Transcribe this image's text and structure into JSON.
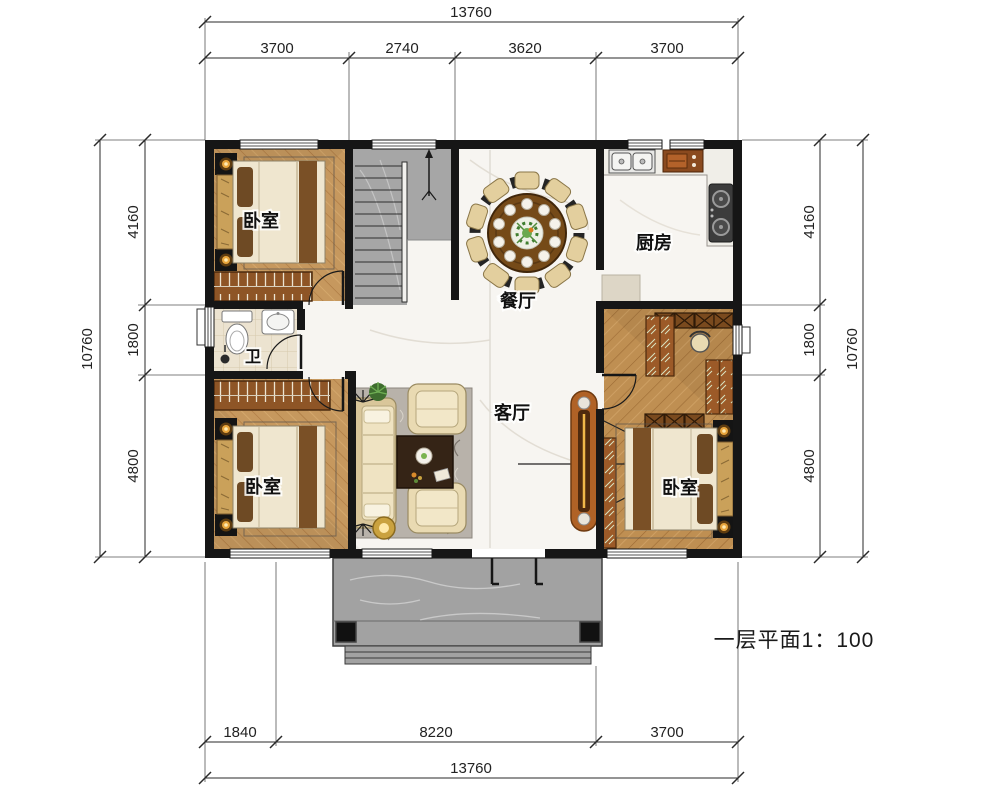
{
  "title": "一层平面1：100",
  "dimensions": {
    "top": {
      "total": "13760",
      "segments": [
        "3700",
        "2740",
        "3620",
        "3700"
      ]
    },
    "bottom": {
      "total": "13760",
      "segments": [
        "1840",
        "8220",
        "3700"
      ]
    },
    "left": {
      "total": "10760",
      "segments": [
        "4160",
        "1800",
        "4800"
      ]
    },
    "right": {
      "total": "10760",
      "segments": [
        "4160",
        "1800",
        "4800"
      ]
    }
  },
  "rooms": {
    "bedroom_top_left": {
      "label": "卧室"
    },
    "kitchen": {
      "label": "厨房"
    },
    "dining": {
      "label": "餐厅"
    },
    "bathroom": {
      "label": "卫"
    },
    "living": {
      "label": "客厅"
    },
    "bedroom_bottom_left": {
      "label": "卧室"
    },
    "bedroom_bottom_right": {
      "label": "卧室"
    }
  },
  "colors": {
    "wall": "#161616",
    "wood_floor": "#c6985e",
    "wood_floor_right": "#bf8f52",
    "marble_floor": "#f7f5f1",
    "stair_gray": "#a6a6a6",
    "porch_gray": "#a2a2a2",
    "wardrobe_brown": "#8e5526",
    "dim_line": "#2a2a2a"
  }
}
